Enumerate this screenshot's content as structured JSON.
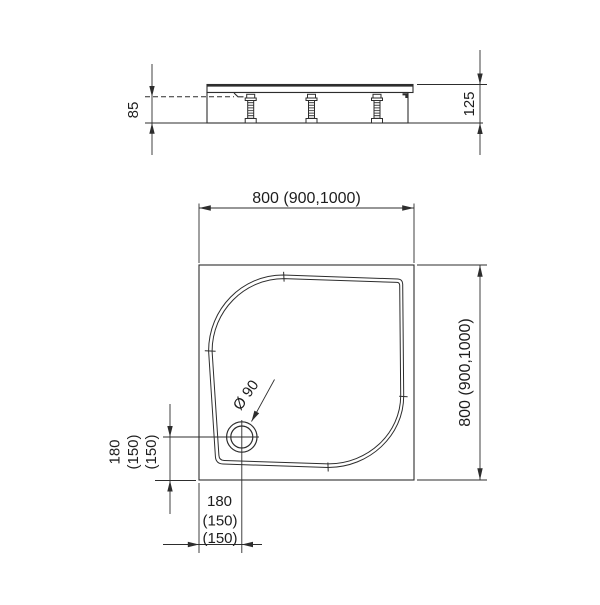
{
  "colors": {
    "background": "#ffffff",
    "line": "#2d2d2d",
    "text": "#1d1d1d"
  },
  "side_view": {
    "dim_clearance_height": "85",
    "dim_total_height": "125"
  },
  "plan_view": {
    "dim_width": "800 (900,1000)",
    "dim_depth": "800 (900,1000)",
    "drain_diameter_label": "Ø 90",
    "drain_offset_left_labels": [
      "180",
      "(150)",
      "(150)"
    ],
    "drain_offset_bottom_labels": [
      "180",
      "(150)",
      "(150)"
    ]
  }
}
